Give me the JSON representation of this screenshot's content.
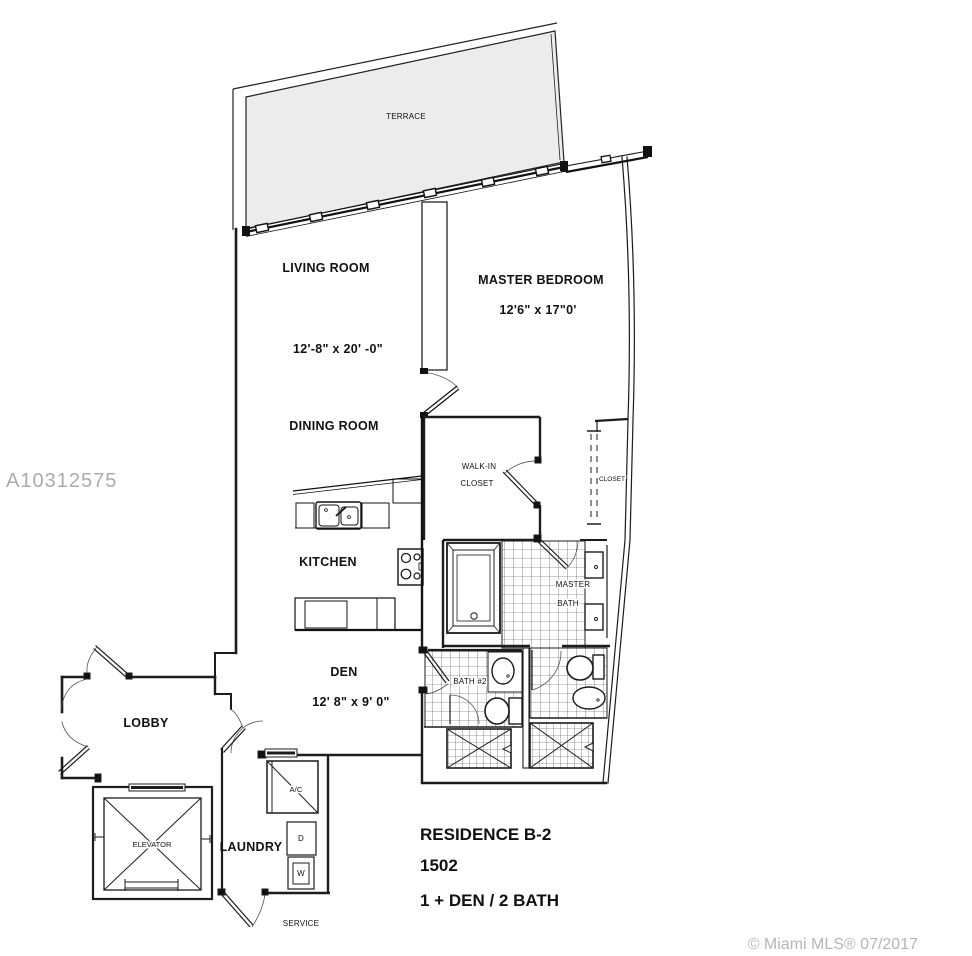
{
  "watermark": {
    "text": "A10312575"
  },
  "footer": {
    "copyright": "© Miami MLS® 07/2017"
  },
  "title": {
    "residence": "RESIDENCE B-2",
    "unit": "1502",
    "layout": "1 + DEN / 2 BATH"
  },
  "rooms": {
    "terrace": {
      "label": "TERRACE"
    },
    "living_room": {
      "label": "LIVING ROOM",
      "dims": "12'-8\" x 20' -0\""
    },
    "master_bedroom": {
      "label": "MASTER BEDROOM",
      "dims": "12'6\" x  17\"0'"
    },
    "dining_room": {
      "label": "DINING ROOM"
    },
    "walk_in_closet": {
      "line1": "WALK-IN",
      "line2": "CLOSET"
    },
    "closet": {
      "label": "CLOSET"
    },
    "kitchen": {
      "label": "KITCHEN"
    },
    "master_bath": {
      "line1": "MASTER",
      "line2": "BATH"
    },
    "den": {
      "label": "DEN",
      "dims": "12' 8\" x 9' 0\""
    },
    "bath2": {
      "label": "BATH #2"
    },
    "lobby": {
      "label": "LOBBY"
    },
    "elevator": {
      "label": "ELEVATOR"
    },
    "laundry": {
      "label": "LAUNDRY",
      "dryer_label": "D",
      "washer_label": "W"
    },
    "ac": {
      "label": "A/C"
    },
    "service": {
      "label": "SERVICE"
    }
  },
  "colors": {
    "wall": "#1c1c1c",
    "terrace_fill": "#ececec",
    "watermark": "#ababab",
    "copyright": "#b5b5b5"
  }
}
